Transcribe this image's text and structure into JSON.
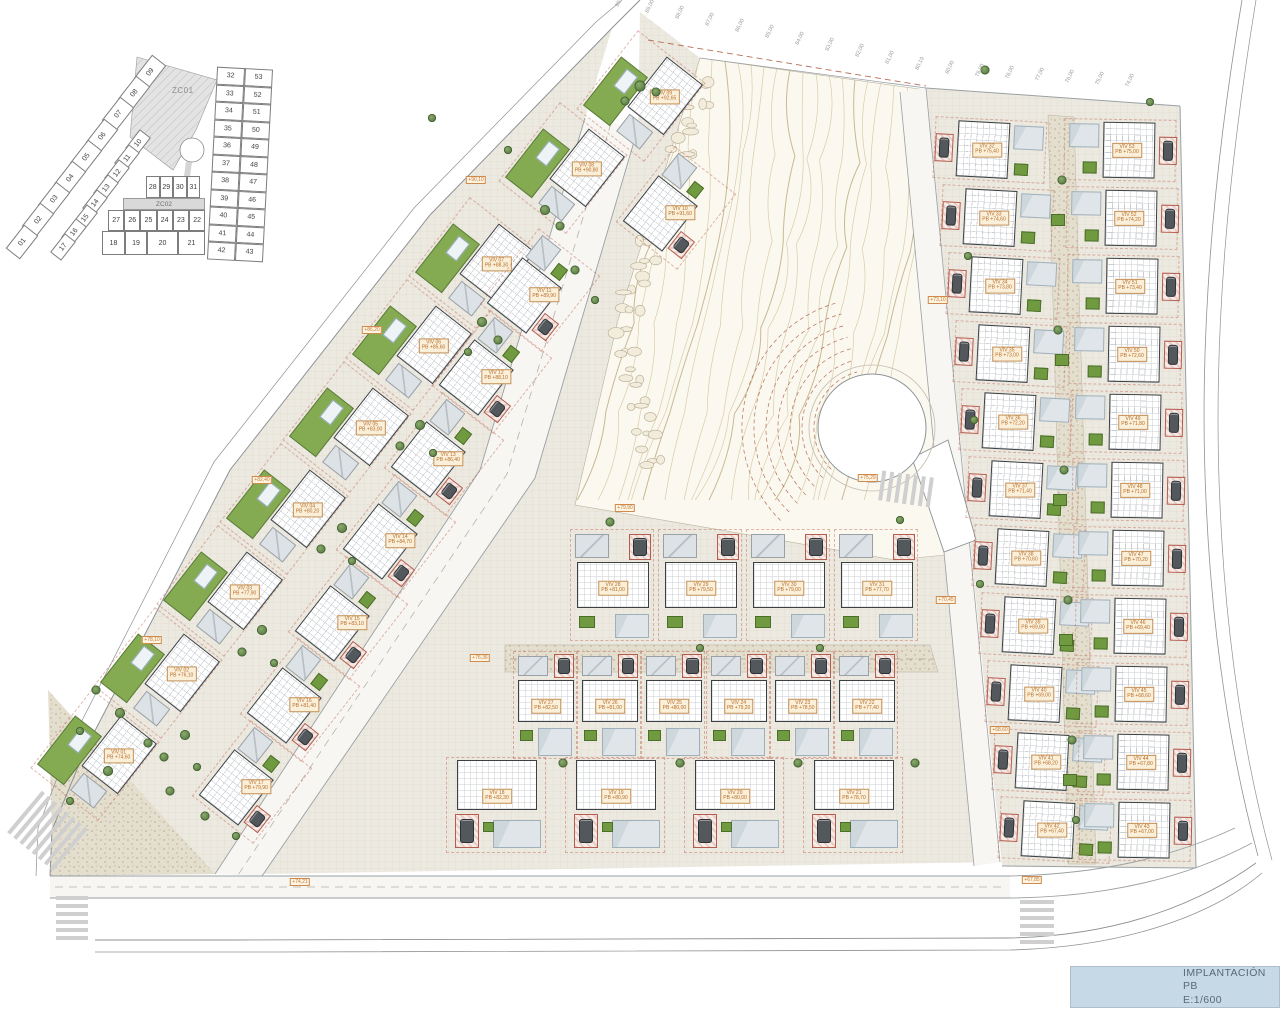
{
  "title_block": {
    "line1": "IMPLANTACIÓN PB",
    "line2": "E:1/600"
  },
  "key_plan": {
    "zone1_label": "ZC01",
    "zone2_label": "ZC02",
    "outer_strip": [
      "09",
      "08",
      "07",
      "06",
      "05",
      "04",
      "03",
      "02",
      "01"
    ],
    "inner_strip": [
      "10",
      "11",
      "12",
      "13",
      "14",
      "15",
      "16",
      "17"
    ],
    "mid_row_top": [
      "28",
      "29",
      "30",
      "31"
    ],
    "mid_row_mid": [
      "27",
      "26",
      "25",
      "24",
      "23",
      "22"
    ],
    "mid_row_bottom": [
      "18",
      "19",
      "20",
      "21"
    ],
    "right_pairs": [
      [
        "32",
        "53"
      ],
      [
        "33",
        "52"
      ],
      [
        "34",
        "51"
      ],
      [
        "35",
        "50"
      ],
      [
        "36",
        "49"
      ],
      [
        "37",
        "48"
      ],
      [
        "38",
        "47"
      ],
      [
        "39",
        "46"
      ],
      [
        "40",
        "45"
      ],
      [
        "41",
        "44"
      ],
      [
        "42",
        "43"
      ]
    ]
  },
  "villas": [
    {
      "id": "01",
      "name": "VIV 01",
      "level": "PB +74,60"
    },
    {
      "id": "02",
      "name": "VIV 02",
      "level": "PB +76,10"
    },
    {
      "id": "03",
      "name": "VIV 03",
      "level": "PB +77,90"
    },
    {
      "id": "04",
      "name": "VIV 04",
      "level": "PB +80,20"
    },
    {
      "id": "05",
      "name": "VIV 05",
      "level": "PB +83,00"
    },
    {
      "id": "06",
      "name": "VIV 06",
      "level": "PB +85,60"
    },
    {
      "id": "07",
      "name": "VIV 07",
      "level": "PB +88,30"
    },
    {
      "id": "08",
      "name": "VIV 08",
      "level": "PB +90,80"
    },
    {
      "id": "09",
      "name": "VIV 09",
      "level": "PB +92,65"
    },
    {
      "id": "10",
      "name": "VIV 10",
      "level": "PB +91,60"
    },
    {
      "id": "11",
      "name": "VIV 11",
      "level": "PB +89,90"
    },
    {
      "id": "12",
      "name": "VIV 12",
      "level": "PB +88,10"
    },
    {
      "id": "13",
      "name": "VIV 13",
      "level": "PB +86,40"
    },
    {
      "id": "14",
      "name": "VIV 14",
      "level": "PB +84,70"
    },
    {
      "id": "15",
      "name": "VIV 15",
      "level": "PB +83,10"
    },
    {
      "id": "16",
      "name": "VIV 16",
      "level": "PB +81,40"
    },
    {
      "id": "17",
      "name": "VIV 17",
      "level": "PB +79,90"
    },
    {
      "id": "18",
      "name": "VIV 18",
      "level": "PB +82,30"
    },
    {
      "id": "19",
      "name": "VIV 19",
      "level": "PB +80,90"
    },
    {
      "id": "20",
      "name": "VIV 20",
      "level": "PB +80,00"
    },
    {
      "id": "21",
      "name": "VIV 21",
      "level": "PB +78,70"
    },
    {
      "id": "22",
      "name": "VIV 22",
      "level": "PB +77,40"
    },
    {
      "id": "23",
      "name": "VIV 23",
      "level": "PB +78,50"
    },
    {
      "id": "24",
      "name": "VIV 24",
      "level": "PB +79,20"
    },
    {
      "id": "25",
      "name": "VIV 25",
      "level": "PB +80,00"
    },
    {
      "id": "26",
      "name": "VIV 26",
      "level": "PB +81,00"
    },
    {
      "id": "27",
      "name": "VIV 27",
      "level": "PB +82,50"
    },
    {
      "id": "28",
      "name": "VIV 28",
      "level": "PB +81,00"
    },
    {
      "id": "29",
      "name": "VIV 29",
      "level": "PB +79,50"
    },
    {
      "id": "30",
      "name": "VIV 30",
      "level": "PB +79,00"
    },
    {
      "id": "31",
      "name": "VIV 31",
      "level": "PB +77,70"
    },
    {
      "id": "32",
      "name": "VIV 32",
      "level": "PB +75,40"
    },
    {
      "id": "33",
      "name": "VIV 33",
      "level": "PB +74,60"
    },
    {
      "id": "34",
      "name": "VIV 34",
      "level": "PB +73,80"
    },
    {
      "id": "35",
      "name": "VIV 35",
      "level": "PB +73,00"
    },
    {
      "id": "36",
      "name": "VIV 36",
      "level": "PB +72,20"
    },
    {
      "id": "37",
      "name": "VIV 37",
      "level": "PB +71,40"
    },
    {
      "id": "38",
      "name": "VIV 38",
      "level": "PB +70,60"
    },
    {
      "id": "39",
      "name": "VIV 39",
      "level": "PB +69,80"
    },
    {
      "id": "40",
      "name": "VIV 40",
      "level": "PB +69,00"
    },
    {
      "id": "41",
      "name": "VIV 41",
      "level": "PB +68,20"
    },
    {
      "id": "42",
      "name": "VIV 42",
      "level": "PB +67,40"
    },
    {
      "id": "43",
      "name": "VIV 43",
      "level": "PB +67,00"
    },
    {
      "id": "44",
      "name": "VIV 44",
      "level": "PB +67,80"
    },
    {
      "id": "45",
      "name": "VIV 45",
      "level": "PB +68,60"
    },
    {
      "id": "46",
      "name": "VIV 46",
      "level": "PB +69,40"
    },
    {
      "id": "47",
      "name": "VIV 47",
      "level": "PB +70,20"
    },
    {
      "id": "48",
      "name": "VIV 48",
      "level": "PB +71,00"
    },
    {
      "id": "49",
      "name": "VIV 49",
      "level": "PB +71,80"
    },
    {
      "id": "50",
      "name": "VIV 50",
      "level": "PB +72,60"
    },
    {
      "id": "51",
      "name": "VIV 51",
      "level": "PB +73,40"
    },
    {
      "id": "52",
      "name": "VIV 52",
      "level": "PB +74,20"
    },
    {
      "id": "53",
      "name": "VIV 53",
      "level": "PB +75,00"
    }
  ],
  "road_markers": [
    "+74,21",
    "+76,36",
    "+79,90",
    "+75,29",
    "+73,10",
    "+70,45",
    "+68,60",
    "+67,85",
    "+82,40",
    "+86,20",
    "+90,10",
    "+78,10"
  ],
  "top_elevations": [
    "90,00",
    "89,00",
    "88,00",
    "87,00",
    "86,00",
    "85,00",
    "84,00",
    "83,00",
    "82,00",
    "81,00",
    "80,19",
    "80,00",
    "79,00",
    "78,00",
    "77,00",
    "76,00",
    "75,00",
    "74,00"
  ],
  "colors": {
    "pool_green": "#6f9a3f",
    "lawn_green": "#84ab52",
    "roof_grey": "#dde2e6",
    "carport_red": "#b65c4e",
    "label_orange": "#b86b28",
    "contour_tan": "#cdbf97",
    "contour_red": "#b4705a",
    "title_band_blue": "#c6d9e7"
  }
}
